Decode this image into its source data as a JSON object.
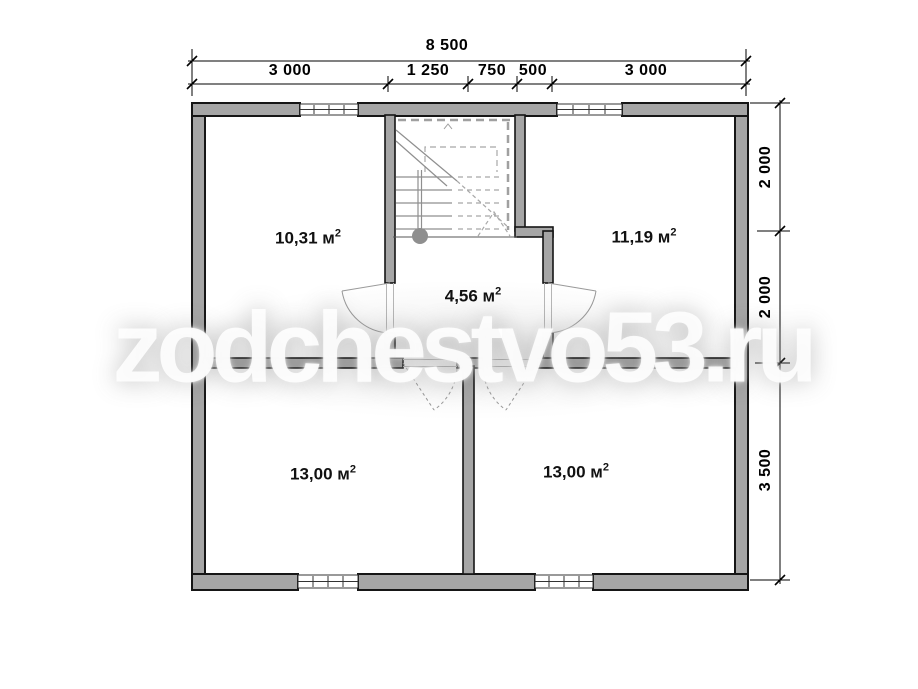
{
  "watermark": {
    "text": "zodchestvo53.ru"
  },
  "dimensions": {
    "top_total": "8 500",
    "top_segments": [
      "3 000",
      "1 250",
      "750",
      "500",
      "3 000"
    ],
    "right_segments": [
      "2 000",
      "2 000",
      "3 500"
    ]
  },
  "rooms": [
    {
      "label": "10,31 м",
      "sup": "2"
    },
    {
      "label": "11,19 м",
      "sup": "2"
    },
    {
      "label": "4,56 м",
      "sup": "2"
    },
    {
      "label": "13,00 м",
      "sup": "2"
    },
    {
      "label": "13,00 м",
      "sup": "2"
    }
  ],
  "colors": {
    "wall_fill": "#a6a6a6",
    "wall_stroke": "#161616",
    "dimension_line": "#000000",
    "stair_line": "#8f8f8f",
    "door_line": "#9a9a9a"
  }
}
